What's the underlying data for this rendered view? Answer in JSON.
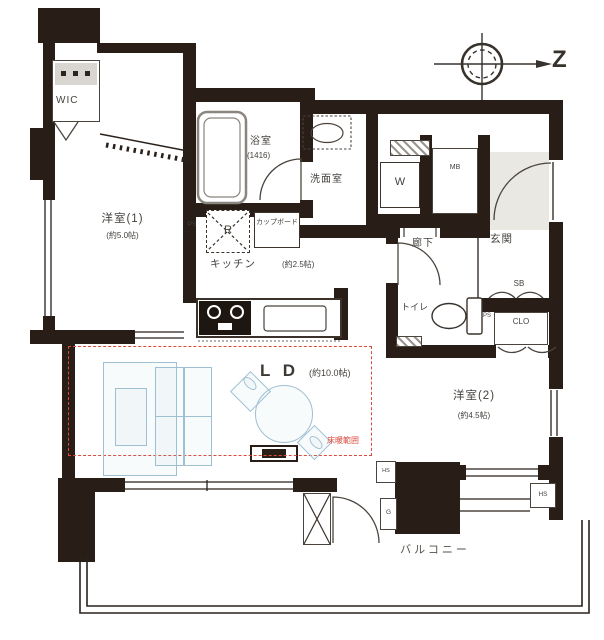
{
  "compass": {
    "north": "Z"
  },
  "rooms": {
    "wic": {
      "label": "WIC"
    },
    "room1": {
      "label": "洋室(1)",
      "size": "(約5.0帖)"
    },
    "bath": {
      "label": "浴室",
      "size": "(1416)"
    },
    "wash": {
      "label": "洗面室"
    },
    "kitchen": {
      "label": "キッチン",
      "size": "(約2.5帖)"
    },
    "ld": {
      "label": "L D",
      "size": "(約10.0帖)"
    },
    "hall": {
      "label": "廊下"
    },
    "genkan": {
      "label": "玄関"
    },
    "toilet": {
      "label": "トイレ"
    },
    "room2": {
      "label": "洋室(2)",
      "size": "(約4.5帖)"
    },
    "balcony": {
      "label": "バルコニー"
    }
  },
  "fixtures": {
    "washer": "W",
    "fridge": "R",
    "cupboard": "カップボード",
    "meter_box": "MB",
    "shoe_box": "SB",
    "closet": "CLO",
    "ps_kitchen": "PS",
    "ps_toilet": "PS",
    "gas": "G",
    "hs_left": "HS",
    "hs_right": "HS"
  },
  "annotations": {
    "floor_heating": "床暖範囲"
  },
  "colors": {
    "wall": "#281e17",
    "furniture_line": "#9fc0d3",
    "floor_heating_line": "#dc4a3c"
  }
}
